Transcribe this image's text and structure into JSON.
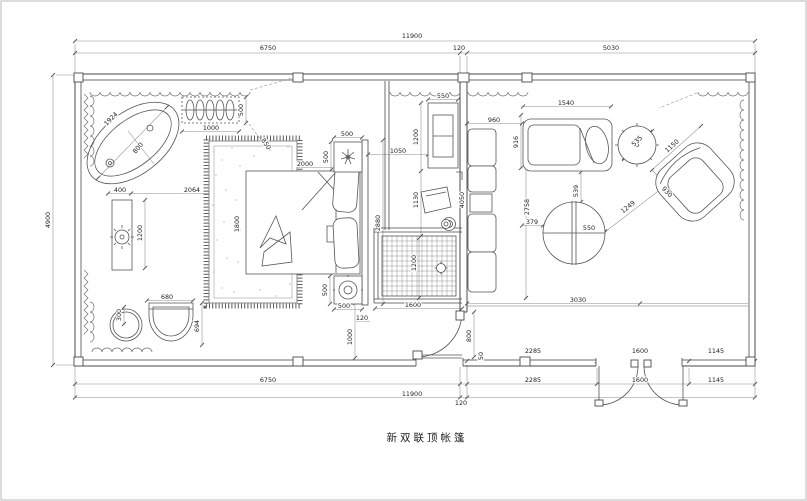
{
  "page": {
    "title": "新双联顶帐篷"
  },
  "dims": {
    "top_total": "11900",
    "top_left": "6750",
    "top_wall": "120",
    "top_right": "5030",
    "left_height": "4900",
    "row1_a": "2285",
    "row1_b": "1600",
    "row1_c": "1145",
    "row2_left": "6750",
    "row2_a": "2285",
    "row2_b": "1600",
    "row2_c": "1145",
    "bottom_total": "11900",
    "bottom_wall": "120",
    "tub_len": "1924",
    "tub_r": "800",
    "rack_w": "1000",
    "rack_h": "500",
    "rack_lead": "850",
    "vanity_w": "400",
    "vanity_gap": "2064",
    "vanity_l": "1200",
    "stool": "300",
    "toilet_w": "680",
    "toilet_h": "694",
    "carpet_h": "1800",
    "bed_w": "2000",
    "ns_top_w": "500",
    "ns_top_h": "500",
    "ns_bot_h": "500",
    "ns_bot_w": "500",
    "bed_wall": "2880",
    "tv_gap": "1050",
    "tv_w": "550",
    "tv_h": "1200",
    "chair_h": "1130",
    "sofa_wall": "4050",
    "sofa_top": "960",
    "sofa_d": "916",
    "living_h": "2758",
    "table_gap": "379",
    "chaise_w": "1540",
    "side_table": "535",
    "table_v": "539",
    "table_r": "550",
    "diag_table": "1249",
    "chair_w": "1150",
    "chair_d": "930",
    "living_w": "3030",
    "door_w": "800",
    "wall_50": "50",
    "shower_w": "1600",
    "shower_h": "1200",
    "gap_120": "120",
    "gap_1000": "1000"
  }
}
